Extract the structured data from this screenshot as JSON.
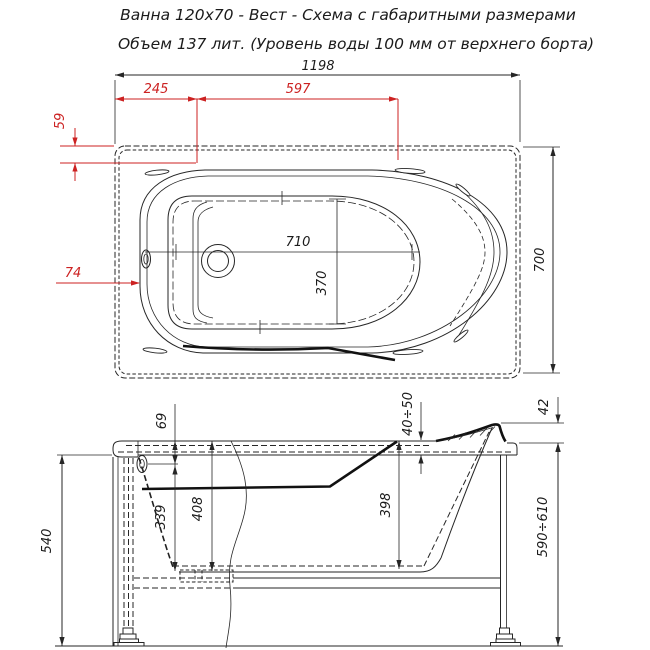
{
  "title": {
    "line1": "Ванна 120х70 - Вест - Схема с габаритными размерами",
    "line2": "Объем 137 лит. (Уровень воды 100 мм от верхнего борта)"
  },
  "colors": {
    "ink": "#262626",
    "dim_red": "#cc2222",
    "paper": "#ffffff"
  },
  "top_view": {
    "overall_width": "1198",
    "drain_offset": "245",
    "lumbar_span": "597",
    "rim_top_inset": "59",
    "rim_side_inset": "74",
    "floor_length": "710",
    "floor_width": "370",
    "plan_height": "700"
  },
  "side_view": {
    "overflow_from_rim": "69",
    "overflow_to_bottom": "339",
    "inner_depth": "408",
    "head_inner_depth": "398",
    "rim_edge_height": "40÷50",
    "headrest_rise": "42",
    "overall_height": "590÷610",
    "panel_height": "540"
  }
}
